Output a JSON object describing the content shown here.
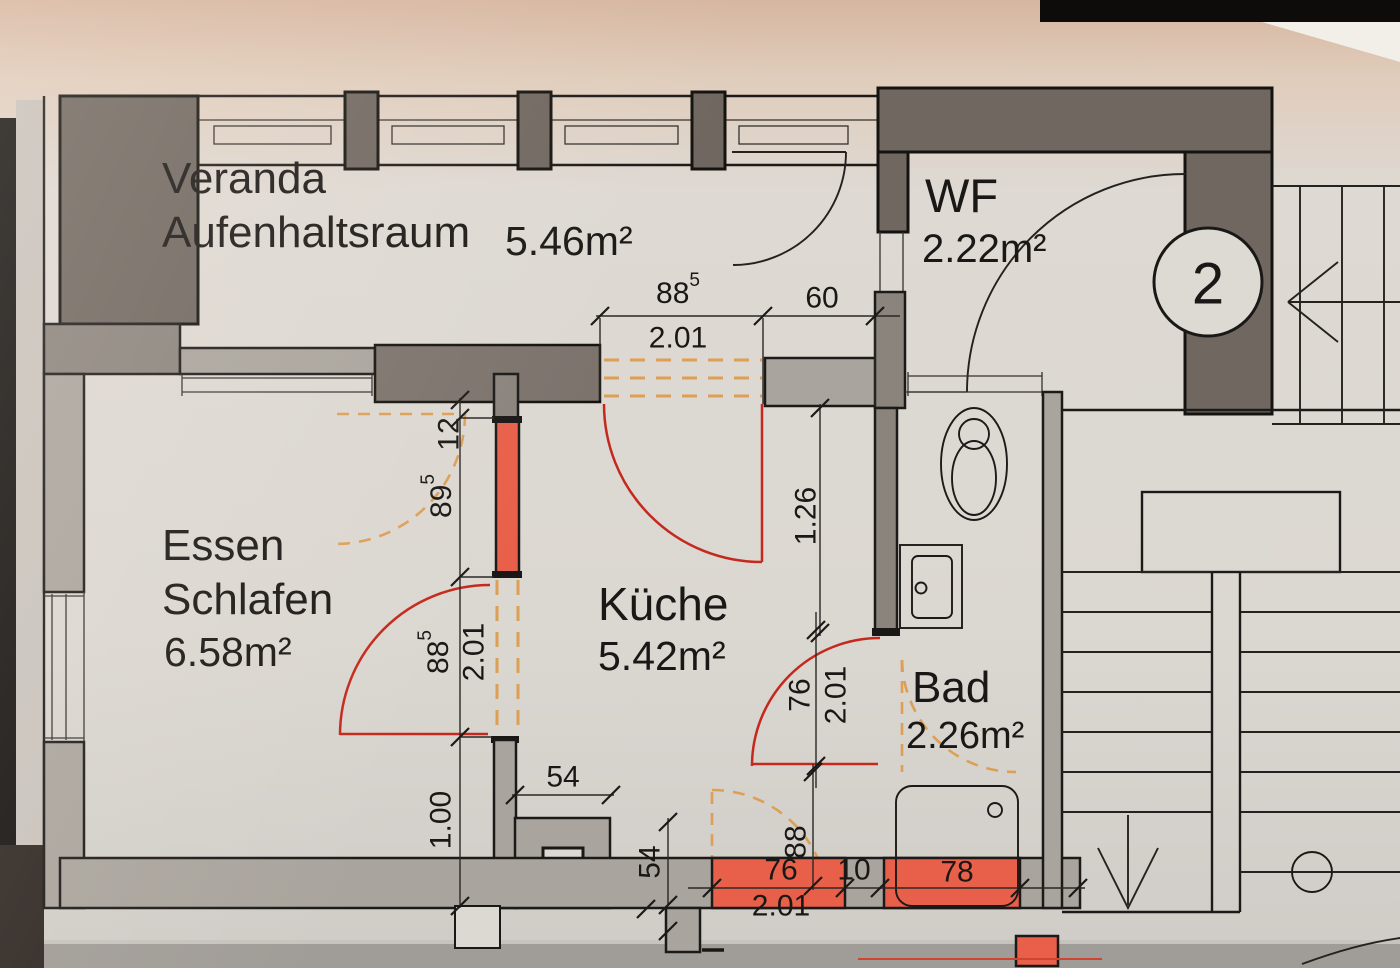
{
  "rooms": {
    "veranda": {
      "label1": "Veranda",
      "label2": "Aufenhaltsraum",
      "area": "5.46m²"
    },
    "wf": {
      "name": "WF",
      "area": "2.22m²"
    },
    "essen_schlafen": {
      "label1": "Essen",
      "label2": "Schlafen",
      "area": "6.58m²"
    },
    "kueche": {
      "name": "Küche",
      "area": "5.42m²"
    },
    "bad": {
      "name": "Bad",
      "area": "2.26m²"
    },
    "unit_number": "2"
  },
  "dimensions": {
    "top_opening": {
      "value": "88",
      "sup": "5",
      "meters": "2.01"
    },
    "top_right": "60",
    "left_gap": "12",
    "left_upper": {
      "value": "89",
      "sup": "5"
    },
    "left_opening": {
      "value": "88",
      "sup": "5",
      "meters": "2.01"
    },
    "left_lower": "1.00",
    "column_width": "54",
    "column_height": "54",
    "kueche_width": "1.26",
    "bad_door": {
      "value": "76",
      "meters": "2.01"
    },
    "bottom_leaf": "88",
    "bottom_door": "76",
    "bottom_pier": "10",
    "bottom_shower": "78",
    "bottom_meters": "2.01"
  },
  "colors": {
    "veranda_label": "#d08540",
    "essen_label": "#cfa23c",
    "red_label": "#c3271a",
    "new_wall_fill": "#e8604a",
    "demolition_dash": "#dd9f55",
    "door_arc_red": "#c5281c"
  }
}
